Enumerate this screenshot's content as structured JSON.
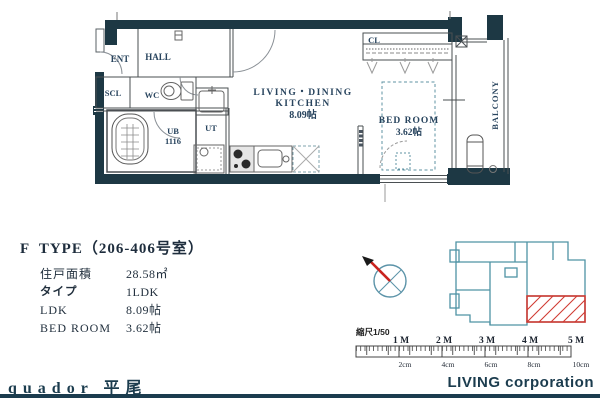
{
  "plan": {
    "rooms": {
      "ent": "ENT",
      "hall": "HALL",
      "scl": "SCL",
      "wc": "WC",
      "ub": "UB",
      "ub_size": "1116",
      "ut": "UT",
      "ldk_line1": "LIVING・DINING",
      "ldk_line2": "KITCHEN",
      "ldk_size": "8.09帖",
      "bedroom": "BED ROOM",
      "bedroom_size": "3.62帖",
      "cl": "CL",
      "balcony": "BALCONY"
    }
  },
  "info": {
    "title": "F  TYPE（206-406号室）",
    "rows": [
      {
        "label": "住戸面積",
        "value": "28.58㎡"
      },
      {
        "label": "タイプ",
        "value": "1LDK"
      },
      {
        "label": "LDK",
        "value": "8.09帖"
      },
      {
        "label": "BED ROOM",
        "value": "3.62帖"
      }
    ]
  },
  "scalebar": {
    "caption": "縮尺1/50",
    "meter_labels": [
      "1 M",
      "2 M",
      "3 M",
      "4 M",
      "5 M"
    ],
    "cm_labels": [
      "2cm",
      "4cm",
      "6cm",
      "8cm",
      "10cm"
    ]
  },
  "footer": {
    "brand": "quador 平尾",
    "company": "LIVING corporation"
  },
  "icons": {
    "north-compass-icon": "teal circle with X cross and red north needle",
    "site-key-plan": "teal building outline with red hatched unit",
    "bathtub-icon": "rounded rect with grid",
    "toilet-icon": "ellipse bowl with tank",
    "wash-basin-icon": "square with faucet cross",
    "washer-space-icon": "dashed square with circle",
    "stove-icon": "rect with dark burners",
    "kitchen-sink-icon": "rounded rect with faucet circle",
    "fridge-space-icon": "dashed square with X",
    "outdoor-unit-icon": "rounded vertical rect"
  },
  "colors": {
    "wall": "#1d3844",
    "brand_teal": "#1b3c4e",
    "site_outline": "#4f93a5",
    "unit_red": "#d03a32",
    "plan_label": "#28445e"
  }
}
